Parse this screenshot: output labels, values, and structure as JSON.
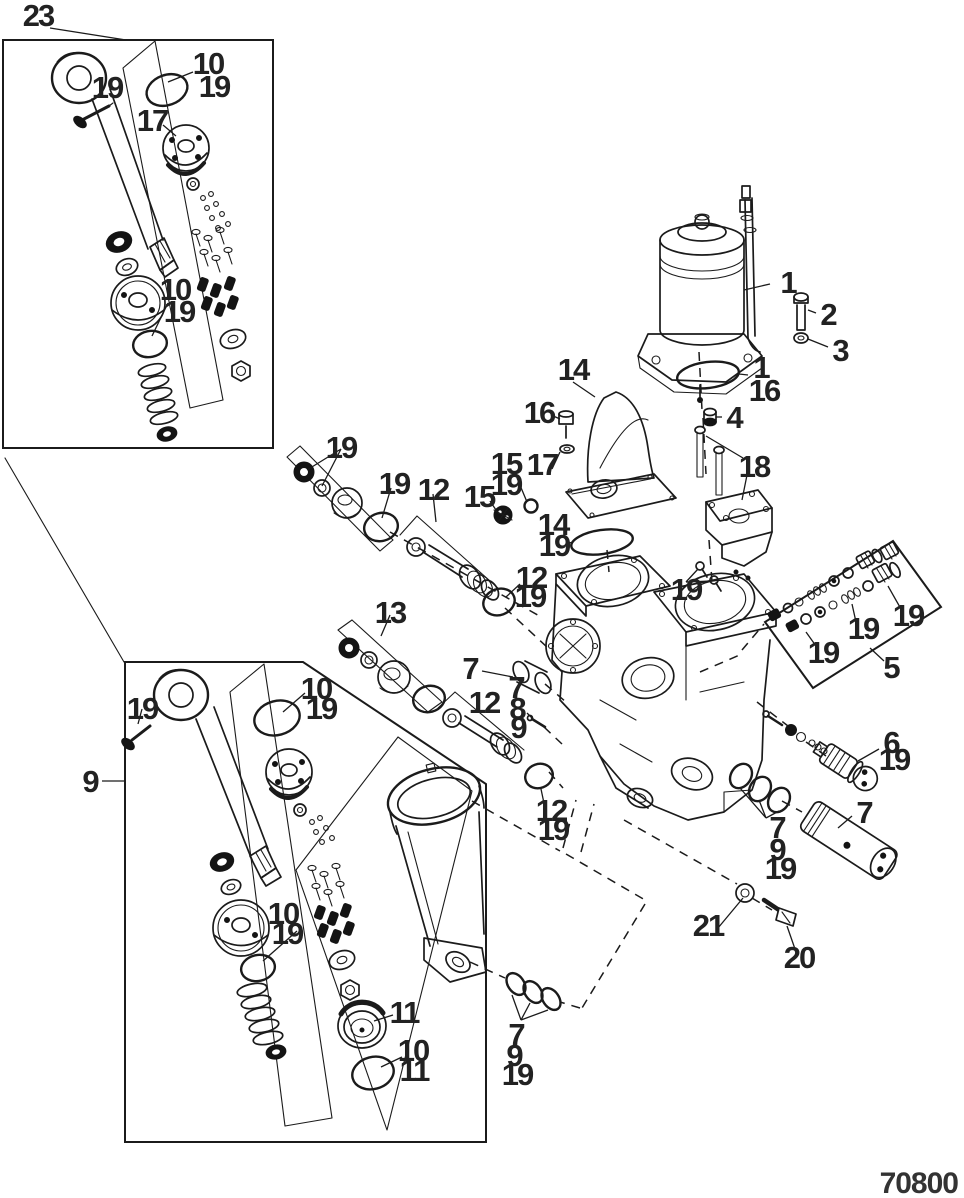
{
  "diagram": {
    "drawing_number": "70800",
    "type": "exploded-parts-view",
    "subject": "power trim pump and cylinder assembly line drawing",
    "colors": {
      "line": "#1b1b1b",
      "label": "#222222",
      "background": "#ffffff"
    },
    "callouts": [
      {
        "label": "23",
        "x": 38,
        "y": 26
      },
      {
        "label": "19",
        "x": 107,
        "y": 98
      },
      {
        "label": "10",
        "x": 208,
        "y": 74
      },
      {
        "label": "19",
        "x": 214,
        "y": 97
      },
      {
        "label": "17",
        "x": 152,
        "y": 131
      },
      {
        "label": "10",
        "x": 175,
        "y": 300
      },
      {
        "label": "19",
        "x": 179,
        "y": 322
      },
      {
        "label": "1",
        "x": 788,
        "y": 293
      },
      {
        "label": "2",
        "x": 828,
        "y": 325
      },
      {
        "label": "3",
        "x": 840,
        "y": 361
      },
      {
        "label": "1",
        "x": 761,
        "y": 378
      },
      {
        "label": "16",
        "x": 764,
        "y": 401
      },
      {
        "label": "4",
        "x": 734,
        "y": 428
      },
      {
        "label": "18",
        "x": 754,
        "y": 477
      },
      {
        "label": "14",
        "x": 573,
        "y": 380
      },
      {
        "label": "16",
        "x": 539,
        "y": 423
      },
      {
        "label": "17",
        "x": 542,
        "y": 475
      },
      {
        "label": "15",
        "x": 506,
        "y": 474
      },
      {
        "label": "19",
        "x": 506,
        "y": 495
      },
      {
        "label": "15",
        "x": 479,
        "y": 507
      },
      {
        "label": "14",
        "x": 553,
        "y": 535
      },
      {
        "label": "19",
        "x": 554,
        "y": 556
      },
      {
        "label": "19",
        "x": 686,
        "y": 600
      },
      {
        "label": "19",
        "x": 341,
        "y": 458
      },
      {
        "label": "19",
        "x": 394,
        "y": 494
      },
      {
        "label": "12",
        "x": 433,
        "y": 500
      },
      {
        "label": "12",
        "x": 531,
        "y": 588
      },
      {
        "label": "19",
        "x": 530,
        "y": 607
      },
      {
        "label": "13",
        "x": 390,
        "y": 623
      },
      {
        "label": "7",
        "x": 470,
        "y": 679
      },
      {
        "label": "7",
        "x": 516,
        "y": 698
      },
      {
        "label": "8",
        "x": 517,
        "y": 719
      },
      {
        "label": "9",
        "x": 518,
        "y": 738
      },
      {
        "label": "12",
        "x": 484,
        "y": 713
      },
      {
        "label": "12",
        "x": 551,
        "y": 821
      },
      {
        "label": "19",
        "x": 553,
        "y": 840
      },
      {
        "label": "19",
        "x": 823,
        "y": 663
      },
      {
        "label": "19",
        "x": 863,
        "y": 639
      },
      {
        "label": "19",
        "x": 908,
        "y": 626
      },
      {
        "label": "5",
        "x": 891,
        "y": 678
      },
      {
        "label": "6",
        "x": 891,
        "y": 753
      },
      {
        "label": "19",
        "x": 894,
        "y": 770
      },
      {
        "label": "7",
        "x": 864,
        "y": 823
      },
      {
        "label": "7",
        "x": 777,
        "y": 838
      },
      {
        "label": "9",
        "x": 777,
        "y": 860
      },
      {
        "label": "19",
        "x": 780,
        "y": 879
      },
      {
        "label": "21",
        "x": 708,
        "y": 936
      },
      {
        "label": "20",
        "x": 799,
        "y": 968
      },
      {
        "label": "9",
        "x": 90,
        "y": 792
      },
      {
        "label": "19",
        "x": 142,
        "y": 719
      },
      {
        "label": "10",
        "x": 316,
        "y": 699
      },
      {
        "label": "19",
        "x": 321,
        "y": 719
      },
      {
        "label": "10",
        "x": 283,
        "y": 924
      },
      {
        "label": "19",
        "x": 287,
        "y": 944
      },
      {
        "label": "11",
        "x": 404,
        "y": 1023
      },
      {
        "label": "10",
        "x": 413,
        "y": 1061
      },
      {
        "label": "11",
        "x": 414,
        "y": 1081
      },
      {
        "label": "7",
        "x": 516,
        "y": 1045
      },
      {
        "label": "9",
        "x": 514,
        "y": 1066
      },
      {
        "label": "19",
        "x": 517,
        "y": 1085
      }
    ]
  }
}
